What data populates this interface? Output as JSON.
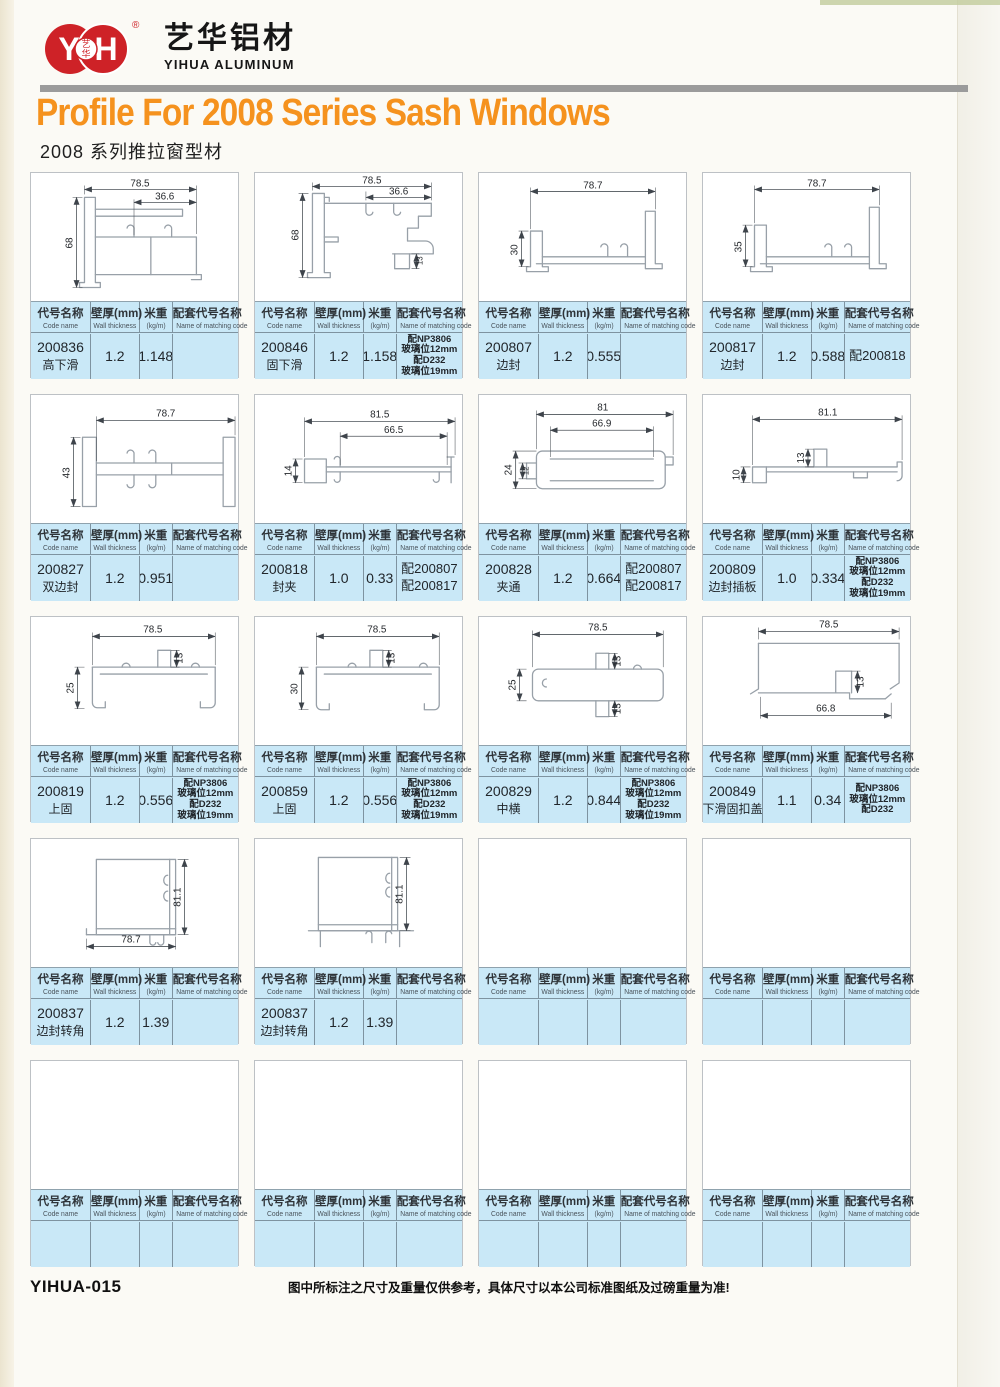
{
  "header": {
    "logo_monogram_left": "Y",
    "logo_monogram_right": "H",
    "logo_badge_top": "艺",
    "logo_badge_bottom": "华",
    "reg_mark": "®",
    "brand_cn": "艺华铝材",
    "brand_en": "YIHUA ALUMINUM",
    "title_en": "Profile For 2008 Series Sash Windows",
    "title_cn": "2008 系列推拉窗型材"
  },
  "table_header": {
    "c1cn": "代号名称",
    "c1en": "Code name",
    "c2cn": "壁厚(mm)",
    "c2en": "Wall thickness",
    "c3cn": "米重",
    "c3en": "(kg/m)",
    "c4cn": "配套代号名称",
    "c4en": "Name of matching code"
  },
  "colors": {
    "accent_orange": "#F5921E",
    "brand_red": "#CE2227",
    "table_blue": "#C9E8F7"
  },
  "footer": {
    "code": "YIHUA-015",
    "note": "图中所标注之尺寸及重量仅供参考，具体尺寸以本公司标准图纸及过磅重量为准!"
  },
  "cells": [
    {
      "code": "200836",
      "name": "高下滑",
      "thickness": "1.2",
      "weight": "1.148",
      "matching": "",
      "dims": {
        "a": "78.5",
        "b": "36.6",
        "c": "68"
      }
    },
    {
      "code": "200846",
      "name": "固下滑",
      "thickness": "1.2",
      "weight": "1.158",
      "matching": "配NP3806\n玻璃位12mm\n配D232\n玻璃位19mm",
      "dims": {
        "a": "78.5",
        "b": "36.6",
        "c": "68",
        "d": "13"
      }
    },
    {
      "code": "200807",
      "name": "边封",
      "thickness": "1.2",
      "weight": "0.555",
      "matching": "",
      "dims": {
        "a": "78.7",
        "c": "30"
      }
    },
    {
      "code": "200817",
      "name": "边封",
      "thickness": "1.2",
      "weight": "0.588",
      "matching": "配200818",
      "dims": {
        "a": "78.7",
        "c": "35"
      }
    },
    {
      "code": "200827",
      "name": "双边封",
      "thickness": "1.2",
      "weight": "0.951",
      "matching": "",
      "dims": {
        "a": "78.7",
        "c": "43"
      }
    },
    {
      "code": "200818",
      "name": "封夹",
      "thickness": "1.0",
      "weight": "0.33",
      "matching": "配200807\n配200817",
      "dims": {
        "a": "81.5",
        "b": "66.5",
        "c": "14"
      }
    },
    {
      "code": "200828",
      "name": "夹通",
      "thickness": "1.2",
      "weight": "0.664",
      "matching": "配200807\n配200817",
      "dims": {
        "a": "81",
        "b": "66.9",
        "c": "24",
        "d": "12"
      }
    },
    {
      "code": "200809",
      "name": "边封插板",
      "thickness": "1.0",
      "weight": "0.334",
      "matching": "配NP3806\n玻璃位12mm\n配D232\n玻璃位19mm",
      "dims": {
        "a": "81.1",
        "b": "13",
        "c": "10"
      }
    },
    {
      "code": "200819",
      "name": "上固",
      "thickness": "1.2",
      "weight": "0.556",
      "matching": "配NP3806\n玻璃位12mm\n配D232\n玻璃位19mm",
      "dims": {
        "a": "78.5",
        "b": "13",
        "c": "25"
      }
    },
    {
      "code": "200859",
      "name": "上固",
      "thickness": "1.2",
      "weight": "0.556",
      "matching": "配NP3806\n玻璃位12mm\n配D232\n玻璃位19mm",
      "dims": {
        "a": "78.5",
        "b": "13",
        "c": "30"
      }
    },
    {
      "code": "200829",
      "name": "中横",
      "thickness": "1.2",
      "weight": "0.844",
      "matching": "配NP3806\n玻璃位12mm\n配D232\n玻璃位19mm",
      "dims": {
        "a": "78.5",
        "b": "13",
        "c": "25",
        "d": "13"
      }
    },
    {
      "code": "200849",
      "name": "下滑固扣盖",
      "thickness": "1.1",
      "weight": "0.34",
      "matching": "配NP3806\n玻璃位12mm\n配D232",
      "dims": {
        "a": "78.5",
        "b": "13",
        "c": "66.8"
      }
    },
    {
      "code": "200837",
      "name": "边封转角",
      "thickness": "1.2",
      "weight": "1.39",
      "matching": "",
      "dims": {
        "a": "81.1",
        "b": "78.7"
      }
    },
    {
      "code": "200837",
      "name": "边封转角",
      "thickness": "1.2",
      "weight": "1.39",
      "matching": "",
      "dims": {
        "a": "81.1"
      }
    },
    {
      "code": "",
      "name": "",
      "thickness": "",
      "weight": "",
      "matching": "",
      "dims": {}
    },
    {
      "code": "",
      "name": "",
      "thickness": "",
      "weight": "",
      "matching": "",
      "dims": {}
    },
    {
      "code": "",
      "name": "",
      "thickness": "",
      "weight": "",
      "matching": "",
      "dims": {}
    },
    {
      "code": "",
      "name": "",
      "thickness": "",
      "weight": "",
      "matching": "",
      "dims": {}
    },
    {
      "code": "",
      "name": "",
      "thickness": "",
      "weight": "",
      "matching": "",
      "dims": {}
    },
    {
      "code": "",
      "name": "",
      "thickness": "",
      "weight": "",
      "matching": "",
      "dims": {}
    }
  ]
}
